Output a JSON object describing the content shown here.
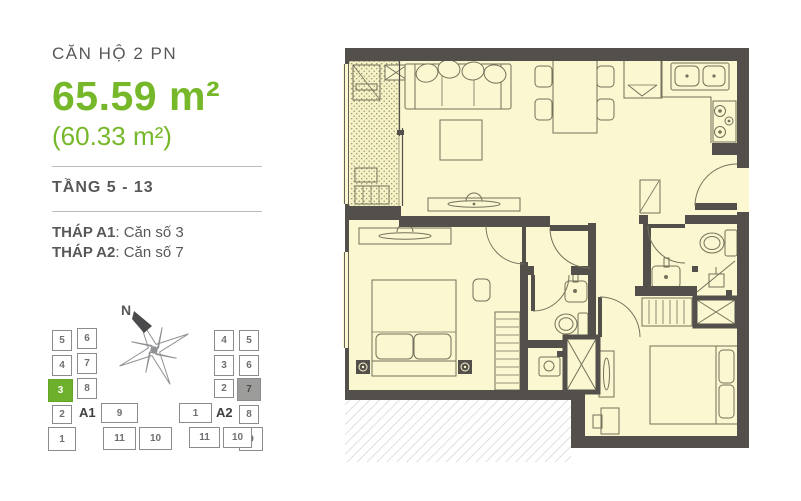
{
  "colors": {
    "accent_green": "#76b82a",
    "text_gray": "#58585a",
    "wall_dark": "#53504c",
    "room_fill": "#fbf7d0",
    "keyplan_highlight_green": "#6cb02b",
    "keyplan_highlight_gray": "#9c9c9b"
  },
  "info_panel": {
    "unit_type": "CĂN HỘ 2 PN",
    "area_main": "65.59 m²",
    "area_sub": "(60.33 m²)",
    "floors": "TẦNG 5 - 13",
    "towers": [
      {
        "label": "THÁP A1",
        "value": ": Căn số 3"
      },
      {
        "label": "THÁP A2",
        "value": ": Căn số 7"
      }
    ]
  },
  "compass": {
    "north_label": "N"
  },
  "keyplans": [
    {
      "id": "a1",
      "label": "A1",
      "cells": [
        {
          "n": "5",
          "x": 4,
          "y": 2,
          "w": 20,
          "h": 21
        },
        {
          "n": "4",
          "x": 4,
          "y": 27,
          "w": 20,
          "h": 21
        },
        {
          "n": "3",
          "x": 0,
          "y": 51,
          "w": 25,
          "h": 23,
          "state": "green"
        },
        {
          "n": "2",
          "x": 4,
          "y": 77,
          "w": 20,
          "h": 19
        },
        {
          "n": "1",
          "x": 0,
          "y": 99,
          "w": 28,
          "h": 24
        },
        {
          "n": "6",
          "x": 29,
          "y": 0,
          "w": 20,
          "h": 21
        },
        {
          "n": "7",
          "x": 29,
          "y": 25,
          "w": 20,
          "h": 21
        },
        {
          "n": "8",
          "x": 29,
          "y": 50,
          "w": 20,
          "h": 21
        },
        {
          "n": "9",
          "x": 53,
          "y": 75,
          "w": 37,
          "h": 20
        },
        {
          "n": "11",
          "x": 55,
          "y": 99,
          "w": 33,
          "h": 23
        },
        {
          "n": "10",
          "x": 91,
          "y": 99,
          "w": 33,
          "h": 23
        }
      ]
    },
    {
      "id": "a2",
      "label": "A2",
      "cells": [
        {
          "n": "4",
          "x": 38,
          "y": 2,
          "w": 20,
          "h": 21
        },
        {
          "n": "3",
          "x": 38,
          "y": 27,
          "w": 20,
          "h": 21
        },
        {
          "n": "2",
          "x": 38,
          "y": 51,
          "w": 20,
          "h": 19
        },
        {
          "n": "1",
          "x": 3,
          "y": 75,
          "w": 33,
          "h": 20
        },
        {
          "n": "5",
          "x": 63,
          "y": 2,
          "w": 20,
          "h": 21
        },
        {
          "n": "6",
          "x": 63,
          "y": 27,
          "w": 20,
          "h": 21
        },
        {
          "n": "7",
          "x": 61,
          "y": 50,
          "w": 24,
          "h": 23,
          "state": "gray"
        },
        {
          "n": "8",
          "x": 63,
          "y": 77,
          "w": 20,
          "h": 19
        },
        {
          "n": "9",
          "x": 63,
          "y": 99,
          "w": 24,
          "h": 24
        },
        {
          "n": "11",
          "x": 13,
          "y": 99,
          "w": 31,
          "h": 21
        },
        {
          "n": "10",
          "x": 47,
          "y": 99,
          "w": 29,
          "h": 21
        }
      ]
    }
  ]
}
